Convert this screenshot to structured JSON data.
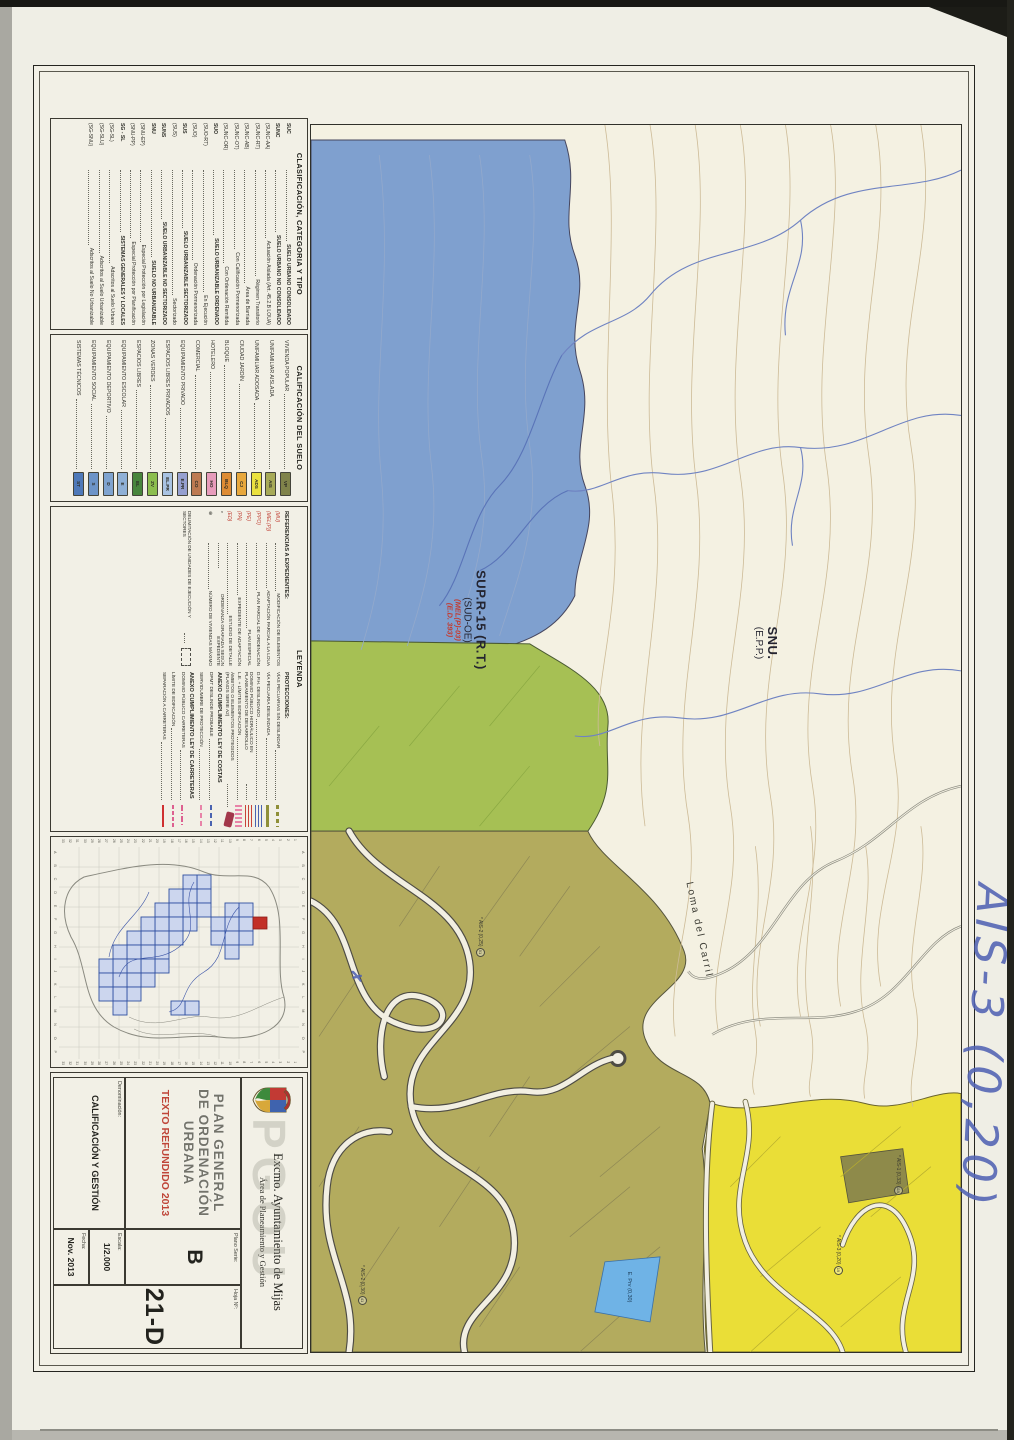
{
  "sheet": {
    "clasificacion": {
      "title": "CLASIFICACIÓN, CATEGORIA Y TIPO",
      "rows": [
        {
          "code": "SUC",
          "text": "SUELO URBANO CONSOLIDADO",
          "bold": true
        },
        {
          "code": "SUNC",
          "text": "SUELO URBANO NO CONSOLIDADO",
          "bold": true
        },
        {
          "code": "(SUNC-AA)",
          "text": "Actuación Aislada (Art. 45.2.B LOUA)",
          "bold": false
        },
        {
          "code": "(SUNC-RT)",
          "text": "Régimen Transitorio",
          "bold": false
        },
        {
          "code": "(SUNC-AB)",
          "text": "Área de Barriada",
          "bold": false
        },
        {
          "code": "(SUNC-OT)",
          "text": "Con Calificación Pormenorizada",
          "bold": false
        },
        {
          "code": "(SUNC-OR)",
          "text": "Con Ordenación Remitida",
          "bold": false
        },
        {
          "code": "SUO",
          "text": "SUELO URBANIZABLE ORDENADO",
          "bold": true
        },
        {
          "code": "(SUO-RT)",
          "text": "En Ejecución",
          "bold": false
        },
        {
          "code": "(SUO)",
          "text": "Ordenación Pormenorizada",
          "bold": false
        },
        {
          "code": "SUS",
          "text": "SUELO URBANIZABLE SECTORIZADO",
          "bold": true
        },
        {
          "code": "(SUS)",
          "text": "Sectorizado",
          "bold": false
        },
        {
          "code": "SUNS",
          "text": "SUELO URBANIZABLE NO SECTORIZADO",
          "bold": true
        },
        {
          "code": "SNU",
          "text": "SUELO NO URBANIZABLE",
          "bold": true
        },
        {
          "code": "(SNU-EP)",
          "text": "Especial Protección por Legislación",
          "bold": false
        },
        {
          "code": "(SNU-PP)",
          "text": "Especial Protección por Planificación",
          "bold": false
        },
        {
          "code": "SG - SL",
          "text": "SISTEMAS GENERALES Y LOCALES",
          "bold": true
        },
        {
          "code": "(SG-SL)",
          "text": "Adscritos al Suelo Urbano",
          "bold": false
        },
        {
          "code": "(SG-SLU)",
          "text": "Adscritos al Suelo Urbanizable",
          "bold": false
        },
        {
          "code": "(SG-SNU)",
          "text": "Adscritos al Suelo No Urbanizable",
          "bold": false
        }
      ]
    },
    "calificacion": {
      "title": "CALIFICACIÓN DEL SUELO",
      "rows": [
        {
          "label": "VIVIENDA POPULAR",
          "code": "VP",
          "color": "#80834a"
        },
        {
          "label": "UNIFAMILIAR AISLADA",
          "code": "AIS",
          "color": "#a7aa57"
        },
        {
          "label": "UNIFAMILIAR ADOSADA",
          "code": "ADS",
          "color": "#eae13e"
        },
        {
          "label": "CIUDAD JARDÍN",
          "code": "CJ",
          "color": "#e8a83c"
        },
        {
          "label": "BLOQUE",
          "code": "BLQ",
          "color": "#de8c34"
        },
        {
          "label": "HOTELERO",
          "code": "HO",
          "color": "#e79cbb"
        },
        {
          "label": "COMERCIAL",
          "code": "CO",
          "color": "#bd7a52"
        },
        {
          "label": "EQUIPAMIENTO PRIVADO",
          "code": "E.PR",
          "color": "#96a0d0"
        },
        {
          "label": "ESPACIOS LIBRES PRIVADOS",
          "code": "EL.PR",
          "color": "#a9c3e2"
        },
        {
          "label": "ZONAS VERDES",
          "code": "ZV",
          "color": "#8cbe4e"
        },
        {
          "label": "ESPACIOS LIBRES",
          "code": "EL",
          "color": "#48853c"
        },
        {
          "label": "EQUIPAMIENTO ESCOLAR",
          "code": "E",
          "color": "#8fb0d6"
        },
        {
          "label": "EQUIPAMIENTO DEPORTIVO",
          "code": "D",
          "color": "#7fa3cf"
        },
        {
          "label": "EQUIPAMIENTO SOCIAL",
          "code": "S",
          "color": "#6d94c8"
        },
        {
          "label": "SISTEMAS TÉCNICOS",
          "code": "ST",
          "color": "#4f79b9"
        }
      ]
    },
    "leyenda": {
      "title": "LEYENDA",
      "referencias": {
        "title": "REFERENCIAS A EXPEDIENTES:",
        "rows": [
          {
            "code": "(MU)",
            "text": "MODIFICACIÓN DE ELEMENTOS",
            "dark": false
          },
          {
            "code": "(MEL(P))",
            "text": "ADAPTACIÓN PARCIAL A LA LOUA",
            "dark": false
          },
          {
            "code": "(PPO)",
            "text": "PLAN PARCIAL DE ORDENACIÓN",
            "dark": false
          },
          {
            "code": "(PE)",
            "text": "PLAN ESPECIAL",
            "dark": false
          },
          {
            "code": "(PA)",
            "text": "EXPEDIENTE DE ADAPTACIÓN",
            "dark": false
          },
          {
            "code": "(ED)",
            "text": "ESTUDIO DE DETALLE",
            "dark": false
          },
          {
            "code": "*",
            "text": "ORDENANZA GRAFIADA SEGÚN EXPEDIENTE",
            "dark": true
          },
          {
            "code": "⊕",
            "text": "NÚMERO DE VIVIENDAS MÁXIMO",
            "dark": true
          }
        ]
      },
      "delimitacion": {
        "text": "DELIMITACIÓN DE UNIDADES DE EJECUCIÓN Y SECTORES"
      },
      "protecciones": {
        "title": "PROTECCIONES:",
        "rows": [
          {
            "text": "VÍAS PECUARIAS SIN DESLINDAR",
            "swatch": "olive-dash"
          },
          {
            "text": "VÍA PECUARIA DESLINDADA",
            "swatch": "olive-solid"
          },
          {
            "text": "D.P.H. DESLINDADO",
            "swatch": "blue-wavy"
          },
          {
            "text": "DOMINIO PÚBLICO HIDRÁULICO EN PLANEAMIENTO DE DESARROLLO",
            "swatch": "red-wavy"
          },
          {
            "text": "L.E. + LÍMITES EDIFICACIÓN",
            "swatch": "pink-hatch"
          },
          {
            "text": "ÁMBITOS O ELEMENTOS PROTEGIDOS (PLANOS SERIE A2)",
            "swatch": "darkred-patch"
          }
        ]
      },
      "costas": {
        "title": "ANEXO CUMPLIMIENTO LEY DE COSTAS",
        "rows": [
          {
            "text": "DPMT DESLINDE PROBABLE",
            "swatch": "blue-dash"
          },
          {
            "text": "SERVIDUMBRE DE PROTECCIÓN",
            "swatch": "pink-dash"
          }
        ]
      },
      "carreteras": {
        "title": "ANEXO CUMPLIMIENTO LEY DE CARRETERAS",
        "rows": [
          {
            "text": "DOMINIO PÚBLICO CARRETERAS",
            "swatch": "pink-dashdot"
          },
          {
            "text": "LÍMITE DE EDIFICACIÓN",
            "swatch": "pink-dash2"
          },
          {
            "text": "SEPARACIÓN A CARRETERAS",
            "swatch": "red-solid"
          }
        ]
      }
    },
    "index_map": {
      "letters": [
        "A",
        "B",
        "C",
        "D",
        "E",
        "F",
        "G",
        "H",
        "I",
        "J",
        "K",
        "L",
        "M",
        "N",
        "O",
        "P"
      ],
      "numbers": [
        "1",
        "2",
        "3",
        "4",
        "5",
        "6",
        "7",
        "8",
        "9",
        "10",
        "11",
        "12",
        "13",
        "14",
        "15",
        "16",
        "17",
        "18",
        "19",
        "20",
        "21",
        "22",
        "23",
        "24",
        "25",
        "26",
        "27",
        "28",
        "29",
        "30",
        "31",
        "32",
        "33"
      ]
    },
    "title_block": {
      "org": "Excmo. Ayuntamiento de Mijas",
      "dept": "Área de Planeamiento y Gestión",
      "watermark": "PGOU",
      "plan_line1": "PLAN GENERAL",
      "plan_line2": "DE ORDENACIÓN URBANA",
      "refundido": "TEXTO REFUNDIDO 2013",
      "denominacion_label": "Denominación:",
      "denominacion": "CALIFICACIÓN Y GESTIÓN",
      "escala_label": "Escala:",
      "escala": "1/2.000",
      "fecha_label": "Fecha:",
      "fecha": "Nov. 2013",
      "serie_label": "Plano Serie:",
      "serie": "B",
      "hoja_label": "Hoja Nº:",
      "hoja": "21-D"
    },
    "map": {
      "labels": {
        "zone1_main": "SUP.R-15 (R.T.)",
        "zone1_sub": "(SUD-OE)",
        "zone1_red1": "(MEL(P)-03)",
        "zone1_red2": "(E.D. 393)",
        "zone2_main": "SNU.",
        "zone2_sub": "(E.P.P.)",
        "place": "Loma del Carril",
        "eprv": "E. Prv (0,30)"
      },
      "parcels": [
        {
          "code": "AIS-1",
          "coef": "(0,33)",
          "num": "119",
          "x": "1030px",
          "y": "58px"
        },
        {
          "code": "AIS-3",
          "coef": "(0,20)",
          "num": "19",
          "x": "1110px",
          "y": "118px"
        },
        {
          "code": "AIS-2",
          "coef": "(0,25)",
          "num": "51",
          "x": "792px",
          "y": "476px"
        },
        {
          "code": "AIS-2",
          "coef": "(0,30)",
          "num": "41",
          "x": "1140px",
          "y": "594px"
        }
      ],
      "annotation_handwritten_1": "AIS-3",
      "annotation_handwritten_2": "(0,20)",
      "annotation_mark": "✗"
    }
  }
}
